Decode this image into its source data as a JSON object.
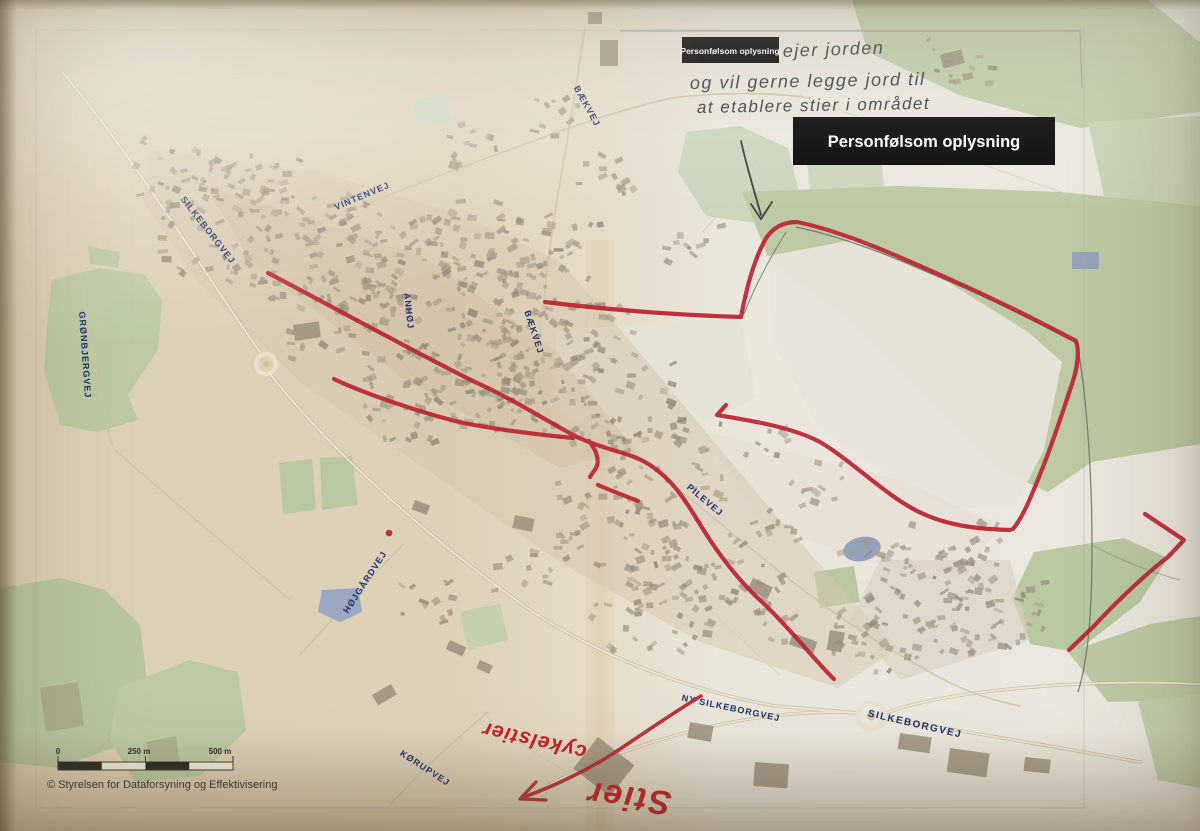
{
  "redactions": {
    "small": "Personfølsom oplysning",
    "large": "Personfølsom oplysning"
  },
  "handwritten_note": {
    "line1": "ejer jorden",
    "line2": "og vil gerne legge jord til",
    "line3": "at etablere stier i området"
  },
  "red_marker_notes": {
    "word_large": "Stier",
    "word_small": "cykelstier"
  },
  "road_labels": {
    "silkeborgvej_nw": "SILKEBORGVEJ",
    "vintenvej": "VINTENVEJ",
    "baekvej_north": "BÆKVEJ",
    "groenbjergvej": "GRØNBJERGVEJ",
    "anhoej": "ANHØJ",
    "baekvej_mid": "BÆKVEJ",
    "pilevej": "PILEVEJ",
    "hoejgaardvej": "HØJGÅRDVEJ",
    "ny_silkeborgvej": "NY SILKEBORGVEJ",
    "silkeborgvej_se": "SILKEBORGVEJ",
    "koerupvej": "KØRUPVEJ"
  },
  "scale_bar": {
    "zero": "0",
    "mid": "250 m",
    "end": "500 m"
  },
  "attribution": "© Styrelsen for Dataforsyning og Effektivisering",
  "colors": {
    "marker_red": "#bb2433",
    "road_label_blue": "#20306b",
    "redaction_bg": "#0a0a0a",
    "redaction_text": "#ffffff",
    "map_green": "#bcc9a4",
    "paper": "#dbcfb6",
    "ink": "#3c4248"
  }
}
